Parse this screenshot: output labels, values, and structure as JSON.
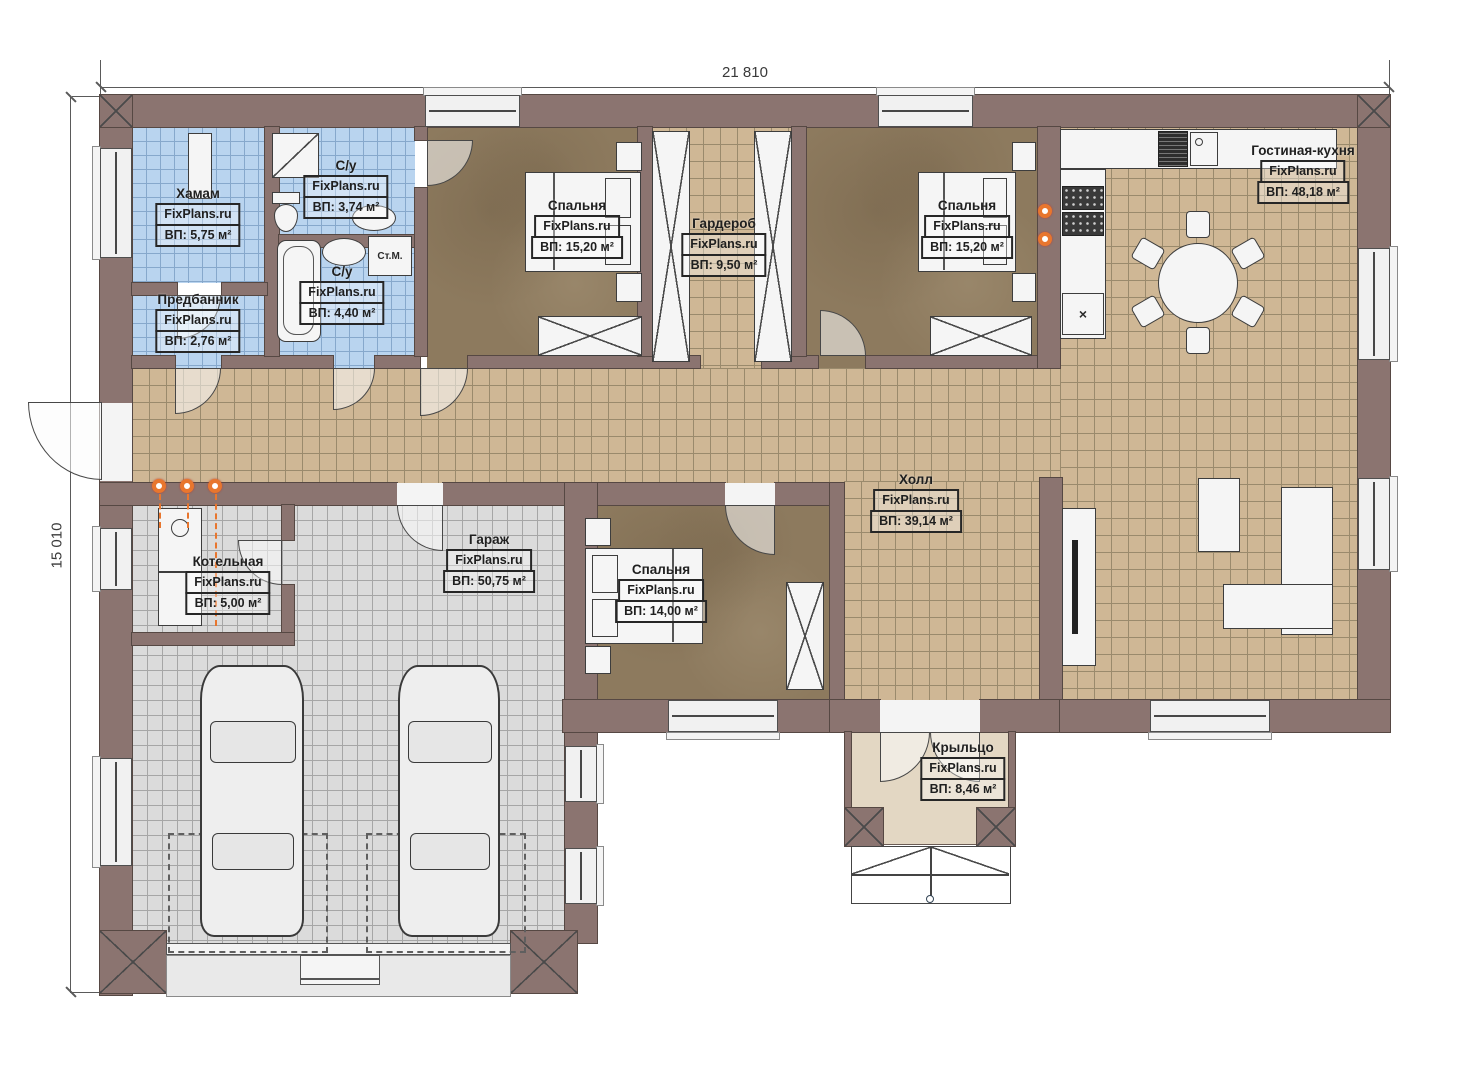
{
  "dimensions": {
    "width_label": "21 810",
    "height_label": "15 010"
  },
  "branding": {
    "site": "FixPlans.ru"
  },
  "rooms": {
    "hamam": {
      "name": "Хамам",
      "site": "FixPlans.ru",
      "area": "ВП: 5,75 м²"
    },
    "entry": {
      "name": "Предбанник",
      "site": "FixPlans.ru",
      "area": "ВП: 2,76 м²"
    },
    "wc1": {
      "name": "С/у",
      "site": "FixPlans.ru",
      "area": "ВП: 3,74 м²"
    },
    "wc2": {
      "name": "С/у",
      "site": "FixPlans.ru",
      "area": "ВП: 4,40 м²"
    },
    "bedroom1": {
      "name": "Спальня",
      "site": "FixPlans.ru",
      "area": "ВП: 15,20 м²"
    },
    "wardrobe": {
      "name": "Гардероб",
      "site": "FixPlans.ru",
      "area": "ВП: 9,50 м²"
    },
    "bedroom2": {
      "name": "Спальня",
      "site": "FixPlans.ru",
      "area": "ВП: 15,20 м²"
    },
    "living_kitchen": {
      "name": "Гостиная-кухня",
      "site": "FixPlans.ru",
      "area": "ВП: 48,18 м²"
    },
    "hall": {
      "name": "Холл",
      "site": "FixPlans.ru",
      "area": "ВП: 39,14 м²"
    },
    "boiler": {
      "name": "Котельная",
      "site": "FixPlans.ru",
      "area": "ВП: 5,00 м²"
    },
    "garage": {
      "name": "Гараж",
      "site": "FixPlans.ru",
      "area": "ВП: 50,75 м²"
    },
    "bedroom3": {
      "name": "Спальня",
      "site": "FixPlans.ru",
      "area": "ВП: 14,00 м²"
    },
    "porch": {
      "name": "Крыльцо",
      "site": "FixPlans.ru",
      "area": "ВП: 8,46 м²"
    }
  },
  "annotations": {
    "washing_machine": "Ст.М."
  },
  "icons": {
    "fridge_mark": "×"
  },
  "colors": {
    "wall": "#8b7470",
    "tile_tan": "#cfb795",
    "tile_blue": "#b9d4ef",
    "tile_gray": "#dbdbdb",
    "floor_brown": "#8d7a5e",
    "porch": "#e3d7c3",
    "accent_orange": "#e8762e"
  }
}
